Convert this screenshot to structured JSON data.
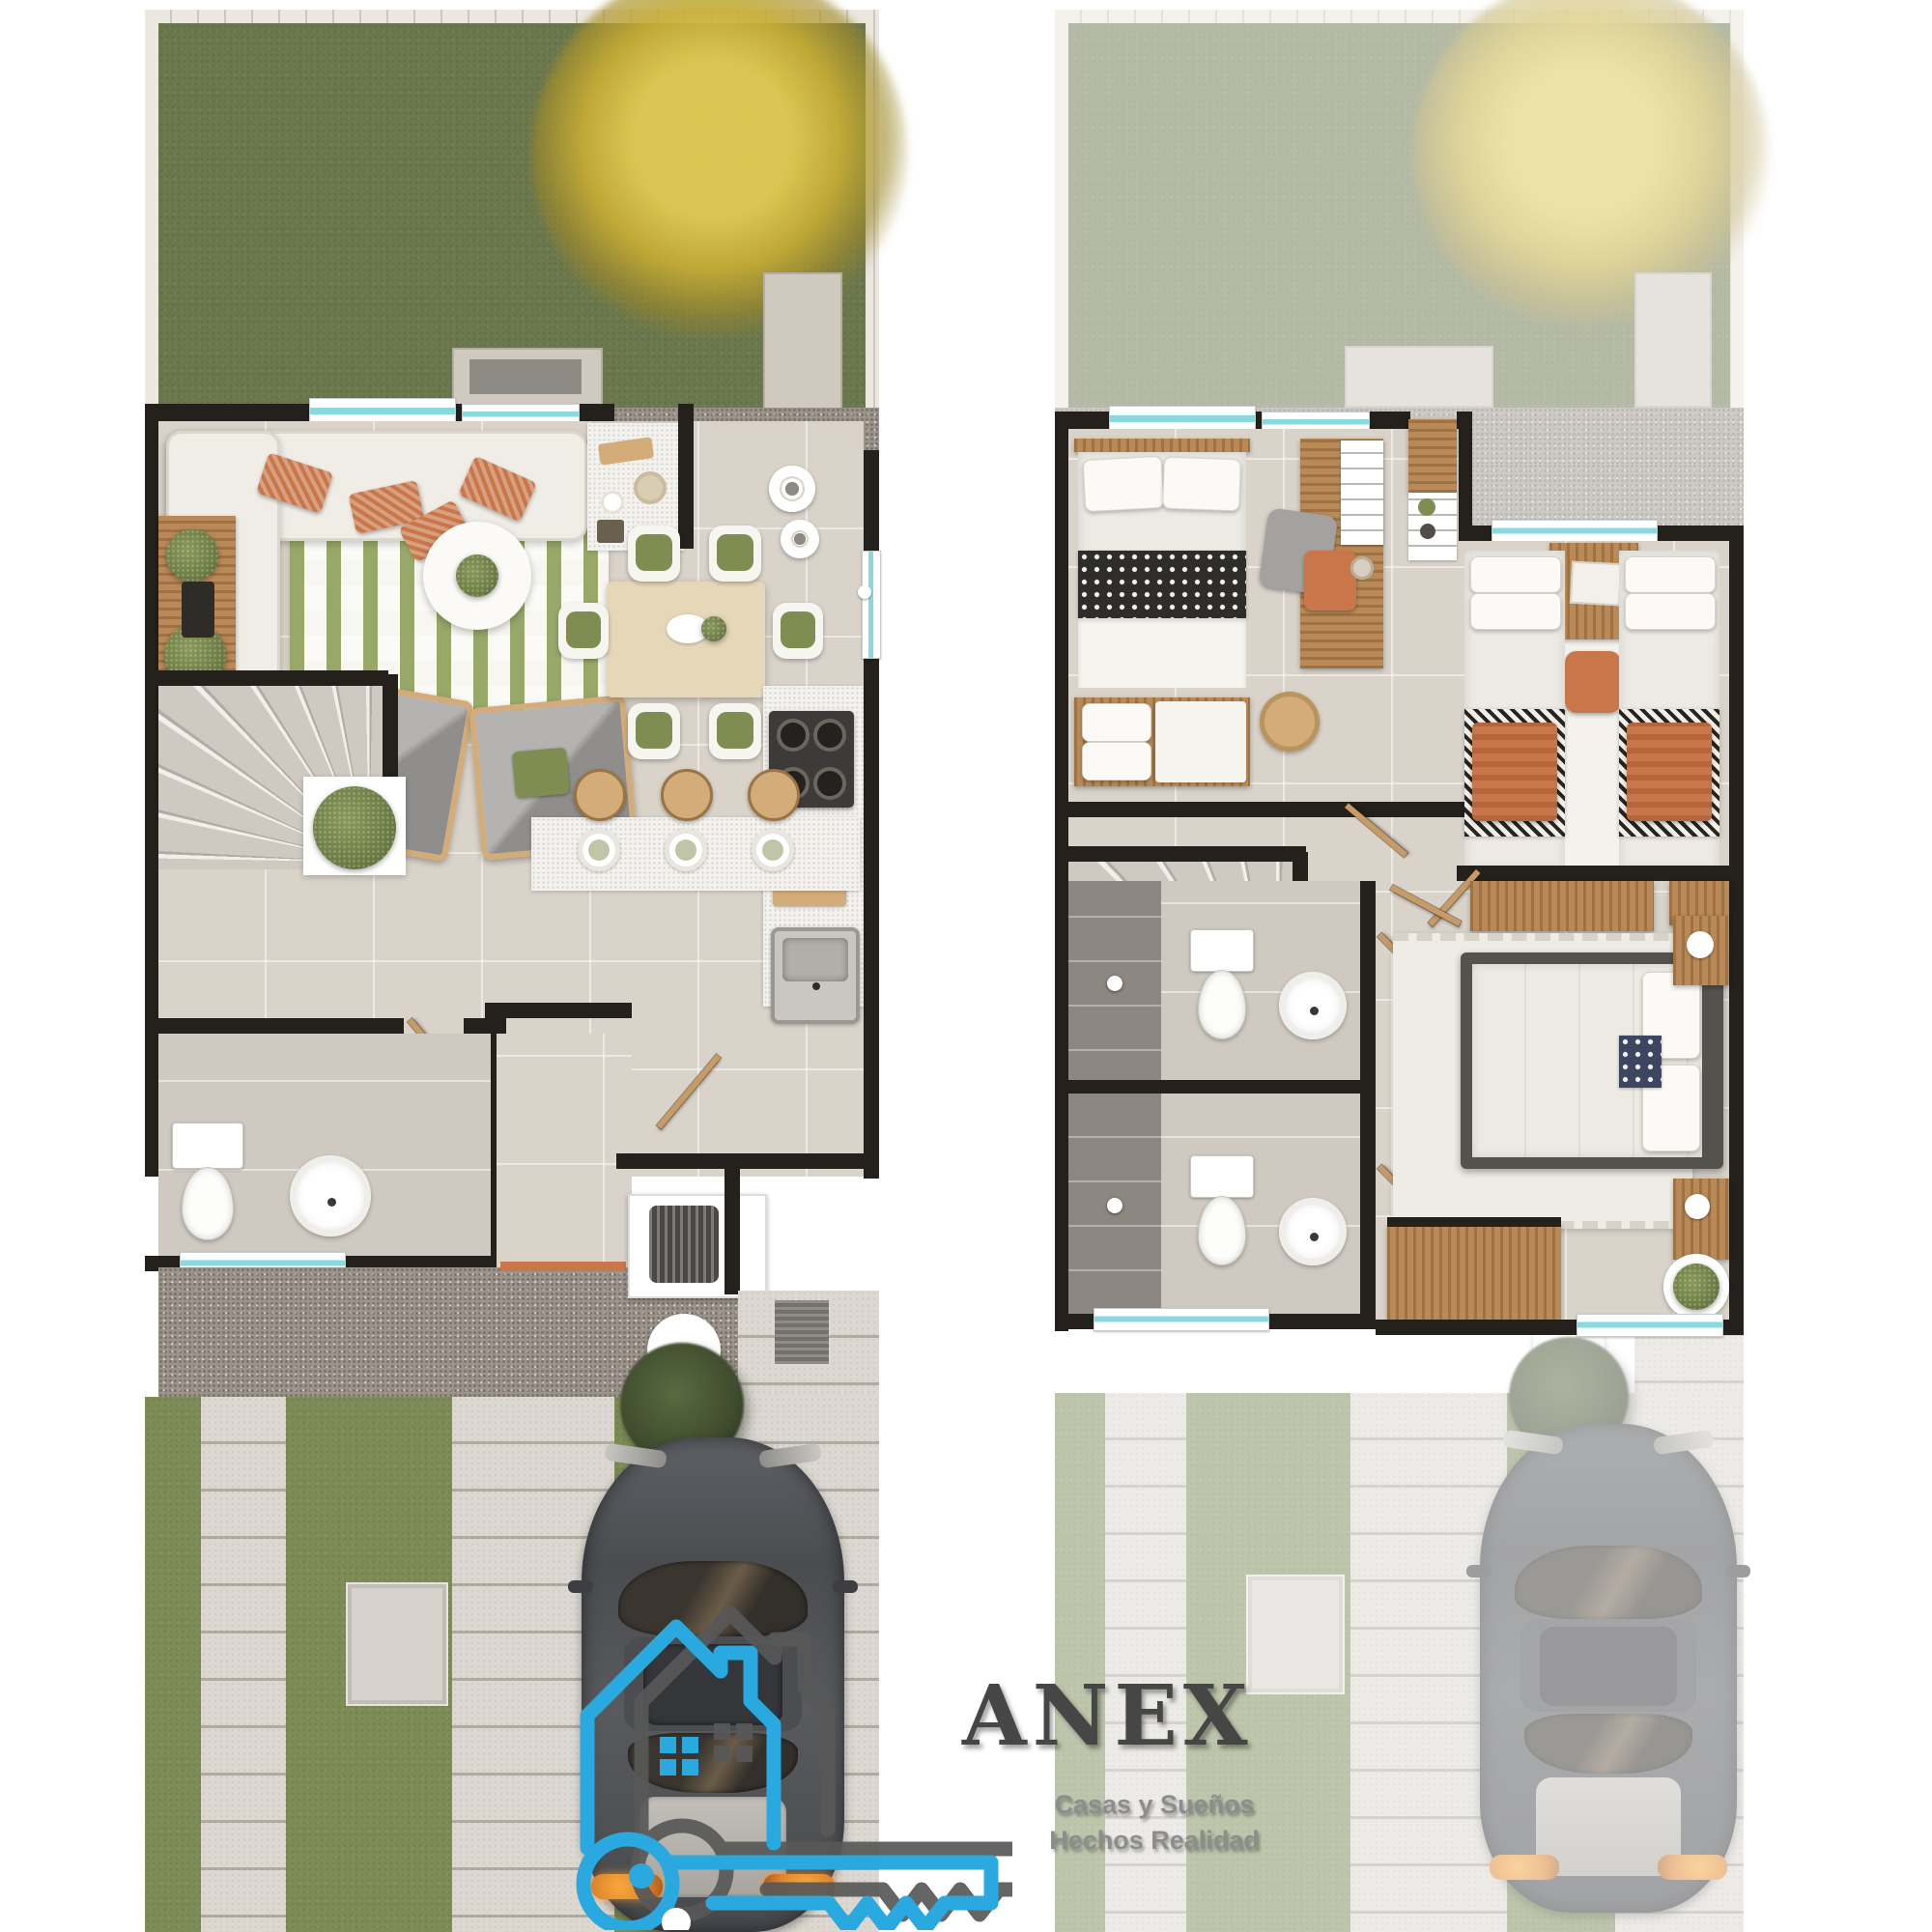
{
  "logo": {
    "brand": "ANEX",
    "tagline_line1": "Casas y Sueños",
    "tagline_line2": "Hechos Realidad",
    "icon": "house-key-icon"
  },
  "panels": [
    {
      "id": "ground-floor-plan",
      "position": "left",
      "faded_context": false,
      "rooms": [
        "backyard-garden",
        "living-room",
        "dining-room",
        "kitchen",
        "breakfast-bar",
        "stairs",
        "half-bathroom",
        "service-patio",
        "entry-porch",
        "front-yard",
        "driveway"
      ],
      "furniture": [
        "l-shaped-sofa",
        "terracotta-throw-pillows",
        "green-wave-rug",
        "round-coffee-table",
        "wood-console-with-plants",
        "two-lounge-chairs",
        "dining-table-with-six-chairs",
        "three-bar-stools",
        "three-place-settings",
        "stove",
        "kitchen-sink",
        "cutting-board",
        "refrigerator",
        "stair-potted-plant",
        "toilet",
        "wash-basin",
        "washing-machine",
        "round-porch-table",
        "door-mat",
        "parked-car",
        "shrub",
        "yellow-tree",
        "concrete-pads"
      ]
    },
    {
      "id": "upper-floor-plan",
      "position": "right",
      "faded_context": true,
      "rooms": [
        "bedroom-1",
        "bedroom-2",
        "master-bedroom",
        "bathroom-1",
        "bathroom-2",
        "stairs",
        "hallway",
        "closets",
        "backyard-garden",
        "front-yard",
        "driveway"
      ],
      "furniture": [
        "single-bed-with-diamond-throw",
        "desk-with-chair",
        "bench-with-pillows",
        "round-tray-table",
        "two-twin-beds",
        "shared-nightstand-with-laptop",
        "orange-stool",
        "chevron-rugs",
        "terracotta-quilts",
        "queen-bed",
        "fringe-rug",
        "two-nightstands",
        "wardrobes",
        "stair-potted-plant",
        "toilets",
        "wash-basins",
        "showers",
        "small-plant",
        "parked-car",
        "shrub",
        "yellow-tree"
      ]
    }
  ],
  "colors": {
    "white": "#ffffff",
    "sidewalk": "#ece7df",
    "grass_back": "#6b784d",
    "grass_front": "#7d8c57",
    "tree_yellow": "#c9ad35",
    "bush_green": "#42502f",
    "wall_black": "#24201c",
    "floor_light": "#d9d3ca",
    "floor_gray": "#cfc9c1",
    "gravel": "#9c948b",
    "paver_light": "#dcd8d1",
    "paver_seam": "#c6c1b9",
    "wood": "#b98a57",
    "wood_light": "#d3ac79",
    "counter_white": "#f4f2ee",
    "sofa_white": "#f0ede7",
    "terracotta": "#c8764a",
    "olive": "#7f8d52",
    "rug_green": "#97a869",
    "gray_chair": "#a3a2a0",
    "appliance_gray": "#9a9a98",
    "stove_dark": "#3c3b39",
    "shower_dark": "#8c8780",
    "pattern_dark": "#2e2d2b",
    "car_body": "#53555a",
    "car_glass": "#38342f",
    "car_trunk": "#b7b4ae",
    "car_light": "#e0832c",
    "window_teal": "#8adadd",
    "logo_blue": "#2aa9e0",
    "logo_gray": "#585858",
    "brand_text": "#464646",
    "tagline_text": "#8d8d8d"
  }
}
